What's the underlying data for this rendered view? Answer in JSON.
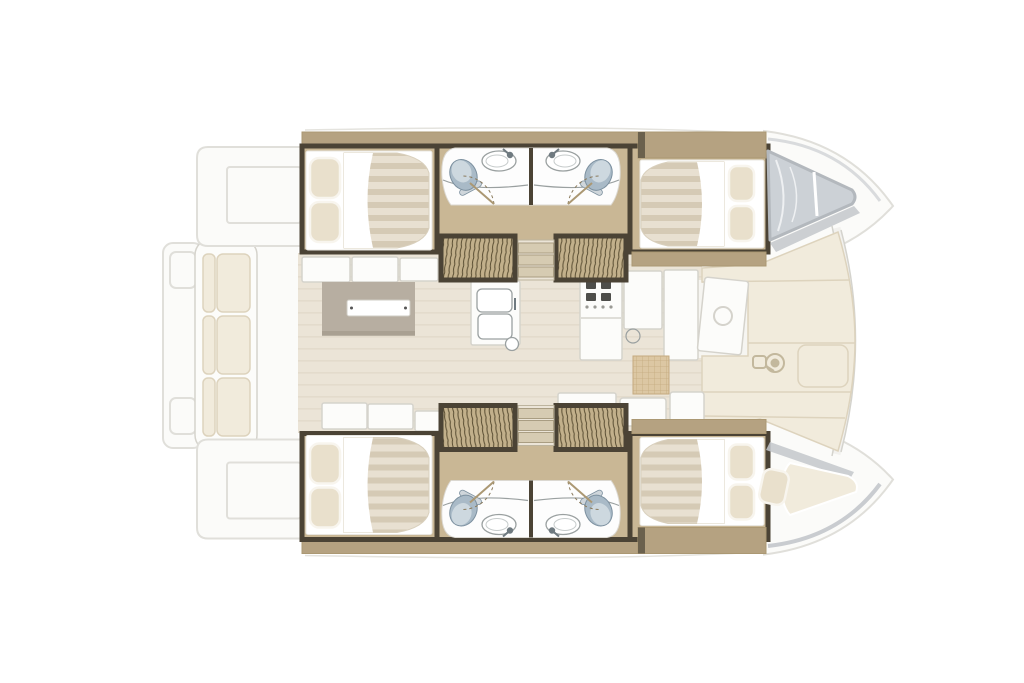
{
  "diagram": {
    "title": "Catamaran interior layout floor plan — top-down view, bow to the right",
    "type": "boat-floor-plan",
    "background": "#ffffff"
  },
  "palette": {
    "deck": "#fbfbf9",
    "deck_line": "#e0dfda",
    "wall": "#4b4335",
    "wall_light": "#6b614d",
    "wood": "#c9b795",
    "wood_dark": "#ab9873",
    "wood_band": "#b5a281",
    "hatch_bg": "#c2b08b",
    "hatch_line": "#5a4e33",
    "bed_stripe_a": "#e8e0d1",
    "bed_stripe_b": "#d5cab5",
    "pillow": "#e9e0cc",
    "pillow_edge": "#f8f5ee",
    "bath_floor": "#fdfdfd",
    "fixture_line": "#9aa0a0",
    "toilet_body": "#a9bac7",
    "toilet_dark": "#7c909f",
    "toilet_lid": "#cdd8df",
    "saloon_floor": "#ebe4d7",
    "saloon_floor_line": "#e3dbcc",
    "table": "#b7aea1",
    "table_shadow": "#a29a8b",
    "white_furniture": "#fcfcfa",
    "furniture_line": "#d5d3cc",
    "cushion": "#f1ebdc",
    "cushion_line": "#ddd3bd",
    "glass": "#ccd1d6",
    "glass_frame": "#b3b8bd",
    "glass_streak": "#eef0f2",
    "mat": "#dcc7a3",
    "mat_line": "#c4aa7f",
    "door_arc": "#8a7a5c"
  },
  "regions": {
    "aft_deck": {
      "label": "Aft deck and swim platforms",
      "features": [
        "swim platform",
        "transom steps",
        "cockpit bench with cushions"
      ]
    },
    "saloon": {
      "label": "Saloon and galley",
      "features": [
        "U-shaped sofa",
        "dining table with runner",
        "double sink",
        "stove with four burners",
        "fridge and cabinets",
        "forward cockpit door",
        "woven mat"
      ]
    },
    "forward_cockpit": {
      "label": "Forward cockpit sun cushions",
      "features": [
        "sun cushions",
        "windlass hatch"
      ]
    },
    "port_hull": {
      "label": "Port hull (top): aft double cabin, two heads with toilet and sink, companionway steps, forward double cabin, bow skylight",
      "rooms": [
        "aft double cabin",
        "aft head",
        "forward head",
        "forward double cabin",
        "bow skylight"
      ]
    },
    "starboard_hull": {
      "label": "Starboard hull (bottom): aft double cabin, two heads with toilet and sink, companionway steps, forward double cabin, forepeak berth",
      "rooms": [
        "aft double cabin",
        "aft head",
        "forward head",
        "forward double cabin",
        "forepeak berth"
      ]
    }
  }
}
